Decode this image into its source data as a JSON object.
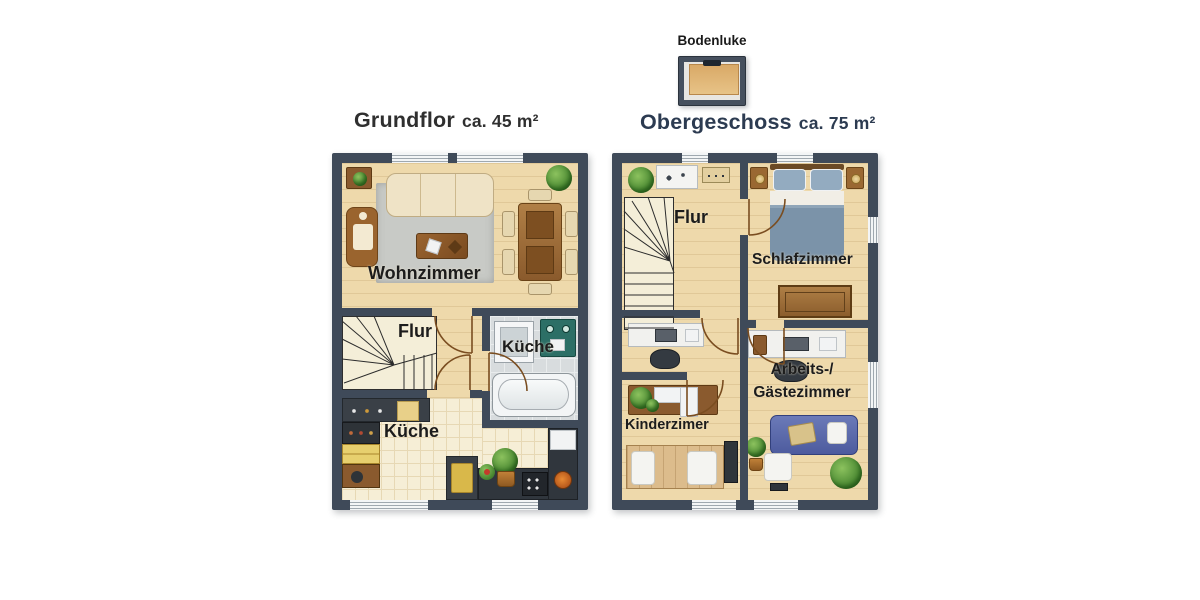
{
  "canvas": {
    "background": "#ffffff"
  },
  "attic": {
    "label": "Bodenluke"
  },
  "floors": [
    {
      "title": "Grundflor",
      "area": "ca. 45 m²",
      "rooms": {
        "living": "Wohnzimmer",
        "hall": "Flur",
        "bath": "Küche",
        "kitchen": "Küche"
      }
    },
    {
      "title": "Obergeschoss",
      "area": "ca. 75 m²",
      "rooms": {
        "hall": "Flur",
        "bedroom": "Schlafzimmer",
        "office_line1": "Arbeits-/",
        "office_line2": "Gästezimmer",
        "kids": "Kinderzimer"
      }
    }
  ],
  "colors": {
    "wall": "#3f4a59",
    "wood_floor": "#eed9ab",
    "tile_gray": "#d8dcde",
    "tile_cream": "#f6eed6",
    "bed_blue": "#7b93a9",
    "sofa_blue": "#5a68ab",
    "appliance_teal": "#2c6f66",
    "title_upper": "#2c3b51",
    "title_ground": "#2f2f2f"
  }
}
